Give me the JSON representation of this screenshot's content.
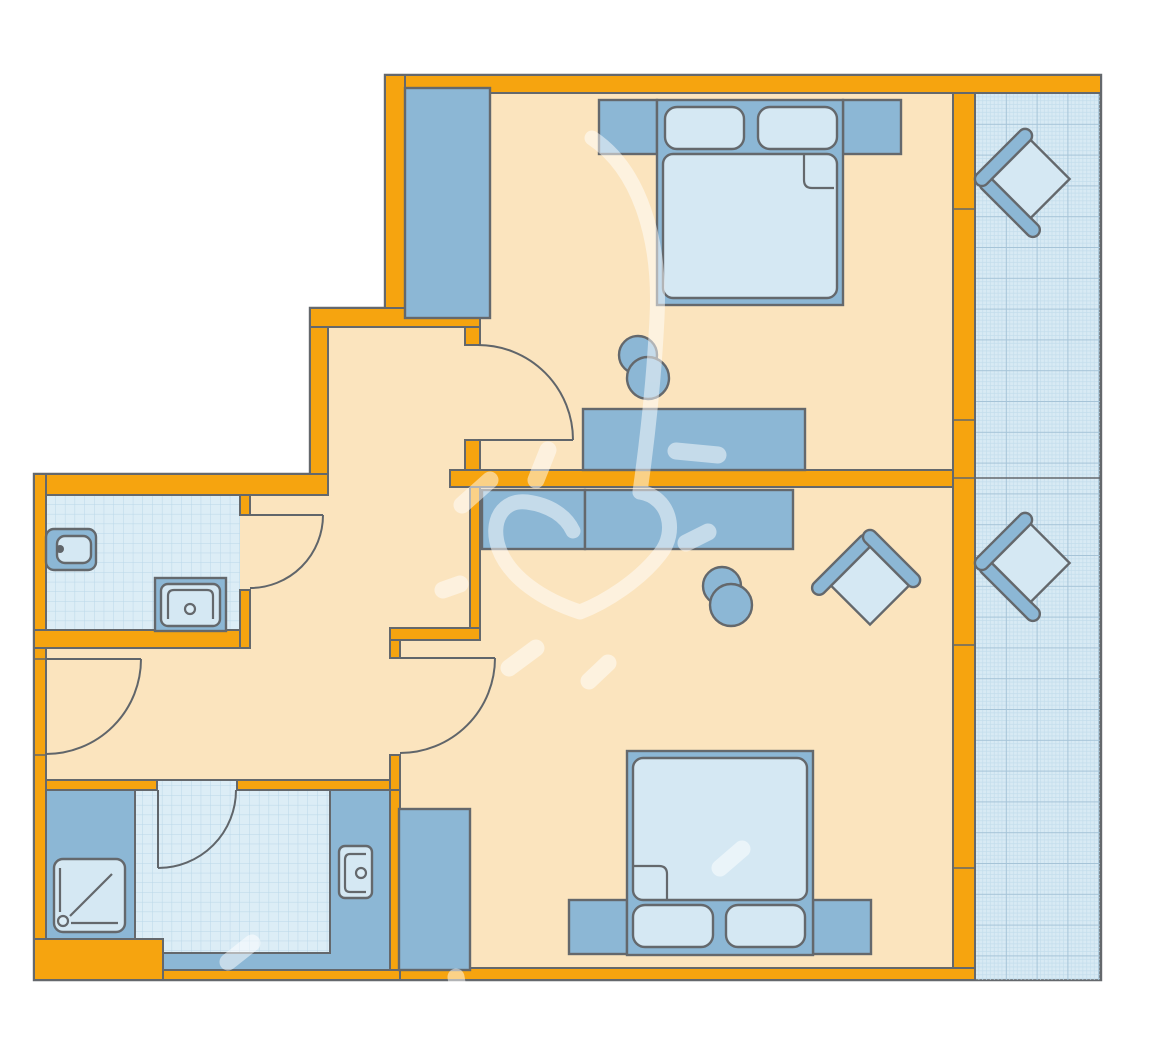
{
  "document": {
    "type": "architectural-floor-plan",
    "title": "",
    "visible_text": "none",
    "background": "#FFFFFF"
  },
  "colors": {
    "canvas": "#FFFFFF",
    "wall": "#F6A40F",
    "outline": "#64686C",
    "floor": "#FBE4BE",
    "furniture": "#8CB7D5",
    "soft": "#D5E8F3",
    "tile_fill": "#DCEDF6",
    "tile_line": "#B9D7E8",
    "balcony_fill": "#D8EAF4",
    "balcony_minor": "#C3DDEC",
    "balcony_major": "#A6C4D8",
    "arc": "#60656A",
    "watermark": "#FFFFFF"
  },
  "watermark": {
    "shape": "heart-with-flourish-brushstrokes",
    "opacity": 0.5
  },
  "plan": {
    "rooms": [
      {
        "id": "bedroom-1",
        "position": "top-right",
        "furniture": [
          "wardrobe",
          "double-bed",
          "nightstand-left",
          "nightstand-right",
          "two-pillows",
          "desk",
          "chair"
        ]
      },
      {
        "id": "bedroom-2",
        "position": "bottom-right",
        "furniture": [
          "double-bed",
          "nightstand-left",
          "nightstand-right",
          "two-pillows",
          "desk",
          "chair",
          "armchair",
          "wardrobe"
        ]
      },
      {
        "id": "bathroom-1",
        "position": "left-upper",
        "furniture": [
          "toilet",
          "washbasin"
        ]
      },
      {
        "id": "bathroom-2",
        "position": "left-lower",
        "furniture": [
          "shower-tray",
          "washbasin"
        ]
      },
      {
        "id": "hallway",
        "position": "center-left",
        "furniture": []
      },
      {
        "id": "balcony",
        "position": "right",
        "furniture": [
          "balcony-chair-upper",
          "balcony-chair-lower"
        ]
      }
    ],
    "doors": [
      {
        "id": "door-bedroom-1",
        "swing": "quarter-arc"
      },
      {
        "id": "door-bedroom-2",
        "swing": "quarter-arc"
      },
      {
        "id": "door-bathroom-1",
        "swing": "quarter-arc"
      },
      {
        "id": "door-bathroom-2",
        "swing": "quarter-arc"
      },
      {
        "id": "door-entrance",
        "swing": "quarter-arc"
      }
    ]
  }
}
